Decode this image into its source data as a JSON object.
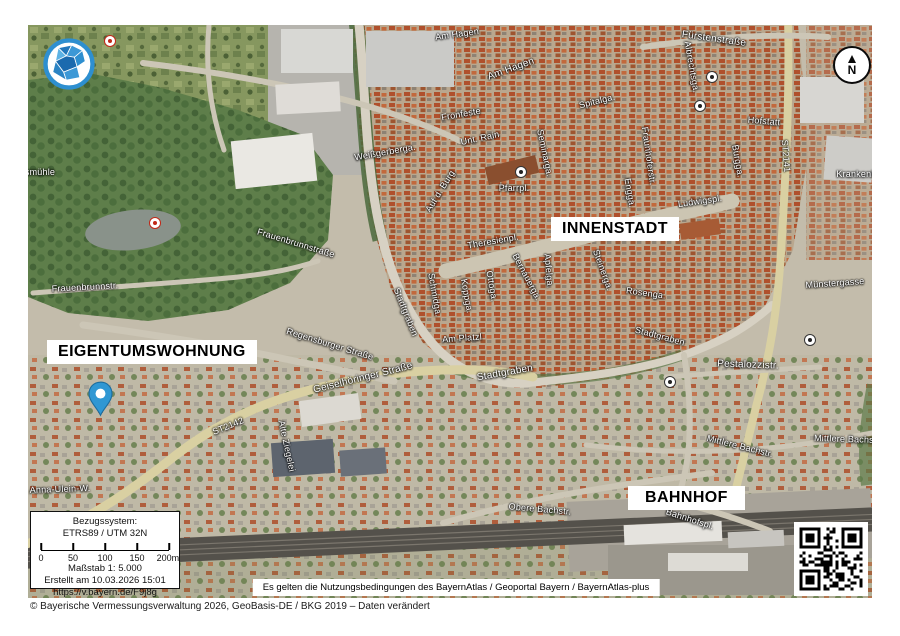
{
  "map": {
    "labels": {
      "innenstadt": "INNENSTADT",
      "eigentumswohnung": "EIGENTUMSWOHNUNG",
      "bahnhof": "BAHNHOF"
    },
    "street_labels": [
      {
        "text": "Am Hagen",
        "x": 429,
        "y": 9,
        "rot": -8
      },
      {
        "text": "Am Hagen",
        "x": 483,
        "y": 44,
        "rot": -20,
        "size": 10
      },
      {
        "text": "Fronfeste",
        "x": 433,
        "y": 89,
        "rot": -10
      },
      {
        "text": "Unt. Rain",
        "x": 452,
        "y": 113,
        "rot": -12
      },
      {
        "text": "Weißgerberga.",
        "x": 357,
        "y": 127,
        "rot": -10
      },
      {
        "text": "Auf d. Burg",
        "x": 412,
        "y": 166,
        "rot": -58
      },
      {
        "text": "Pfarrpl.",
        "x": 486,
        "y": 163,
        "rot": 0
      },
      {
        "text": "Seminarga.",
        "x": 517,
        "y": 128,
        "rot": 78
      },
      {
        "text": "Spitalga.",
        "x": 569,
        "y": 76,
        "rot": -14
      },
      {
        "text": "Fürstenstraße",
        "x": 686,
        "y": 14,
        "rot": 8,
        "size": 10
      },
      {
        "text": "Albrechtsga.",
        "x": 664,
        "y": 42,
        "rot": 80
      },
      {
        "text": "Fraunhoferstr.",
        "x": 621,
        "y": 131,
        "rot": 82
      },
      {
        "text": "Engga.",
        "x": 602,
        "y": 168,
        "rot": 80
      },
      {
        "text": "Ludwigspl.",
        "x": 672,
        "y": 176,
        "rot": -8
      },
      {
        "text": "Burgga.",
        "x": 710,
        "y": 136,
        "rot": 80
      },
      {
        "text": "Hofstatt",
        "x": 736,
        "y": 96,
        "rot": 5
      },
      {
        "text": "ST2141",
        "x": 758,
        "y": 131,
        "rot": 85
      },
      {
        "text": "Krankenhaus",
        "x": 836,
        "y": 149,
        "rot": 0
      },
      {
        "text": "Theresienpl.",
        "x": 465,
        "y": 216,
        "rot": -10
      },
      {
        "text": "Apfelga.",
        "x": 521,
        "y": 246,
        "rot": 85
      },
      {
        "text": "Bernauerga.",
        "x": 499,
        "y": 252,
        "rot": 62
      },
      {
        "text": "Steinerga.",
        "x": 575,
        "y": 245,
        "rot": 70
      },
      {
        "text": "Rosenga.",
        "x": 618,
        "y": 268,
        "rot": 8
      },
      {
        "text": "Schmidga.",
        "x": 407,
        "y": 270,
        "rot": 80
      },
      {
        "text": "Koppga.",
        "x": 439,
        "y": 271,
        "rot": 80
      },
      {
        "text": "Ottoga.",
        "x": 464,
        "y": 261,
        "rot": 80
      },
      {
        "text": "Am Platzl",
        "x": 434,
        "y": 313,
        "rot": -4
      },
      {
        "text": "Stadtgraben",
        "x": 378,
        "y": 287,
        "rot": 68
      },
      {
        "text": "Stadtgraben",
        "x": 477,
        "y": 348,
        "rot": -10,
        "size": 10
      },
      {
        "text": "Stadtgraben",
        "x": 632,
        "y": 311,
        "rot": 15
      },
      {
        "text": "Münstergasse",
        "x": 807,
        "y": 258,
        "rot": -4
      },
      {
        "text": "Pestalozzistr.",
        "x": 720,
        "y": 340,
        "rot": 2,
        "size": 10
      },
      {
        "text": "Mittlere Bachstr.",
        "x": 712,
        "y": 421,
        "rot": 14
      },
      {
        "text": "Mittlere Bachstr.",
        "x": 820,
        "y": 414,
        "rot": 2
      },
      {
        "text": "Obere Bachstr.",
        "x": 512,
        "y": 484,
        "rot": 5
      },
      {
        "text": "Bahnhofspl.",
        "x": 662,
        "y": 494,
        "rot": 18
      },
      {
        "text": "Geiselhöringer Straße",
        "x": 335,
        "y": 353,
        "rot": -14,
        "size": 10
      },
      {
        "text": "Regensburger Straße",
        "x": 302,
        "y": 319,
        "rot": 17
      },
      {
        "text": "Frauenbrunnstr.",
        "x": 57,
        "y": 262,
        "rot": -3
      },
      {
        "text": "Frauenbrunnstraße",
        "x": 268,
        "y": 218,
        "rot": 17
      },
      {
        "text": "ST2142",
        "x": 200,
        "y": 401,
        "rot": -22
      },
      {
        "text": "Anna-Ulein-W.",
        "x": 32,
        "y": 464,
        "rot": -2
      },
      {
        "text": "smühle",
        "x": 12,
        "y": 147,
        "rot": 0
      },
      {
        "text": "Alte Ziegelei",
        "x": 259,
        "y": 421,
        "rot": 78
      }
    ],
    "pois": [
      {
        "type": "church-icon",
        "x": 493,
        "y": 147
      },
      {
        "type": "church-icon",
        "x": 684,
        "y": 52
      },
      {
        "type": "church-icon",
        "x": 672,
        "y": 81
      },
      {
        "type": "church-icon",
        "x": 782,
        "y": 315
      },
      {
        "type": "church-icon",
        "x": 642,
        "y": 357
      },
      {
        "type": "flower-icon",
        "x": 127,
        "y": 198
      },
      {
        "type": "flower-icon",
        "x": 82,
        "y": 16
      }
    ]
  },
  "compass": {
    "letter": "N"
  },
  "info_box": {
    "line1": "Bezugssystem:",
    "line2": "ETRS89 / UTM 32N",
    "scale_ticks": [
      "0",
      "50",
      "100",
      "150",
      "200m"
    ],
    "scale": "Maßstab 1: 5.000",
    "created": "Erstellt am 10.03.2026 15:01",
    "url": "https://v.bayern.de/F9j8g"
  },
  "terms": "Es gelten die Nutzungsbedingungen des BayernAtlas / Geoportal Bayern / BayernAtlas-plus",
  "copyright": "© Bayerische Vermessungsverwaltung 2026, GeoBasis-DE / BKG 2019 – Daten verändert",
  "colors": {
    "pin_blue": "#2f97d3",
    "logo_blue": "#2e8fd0"
  }
}
